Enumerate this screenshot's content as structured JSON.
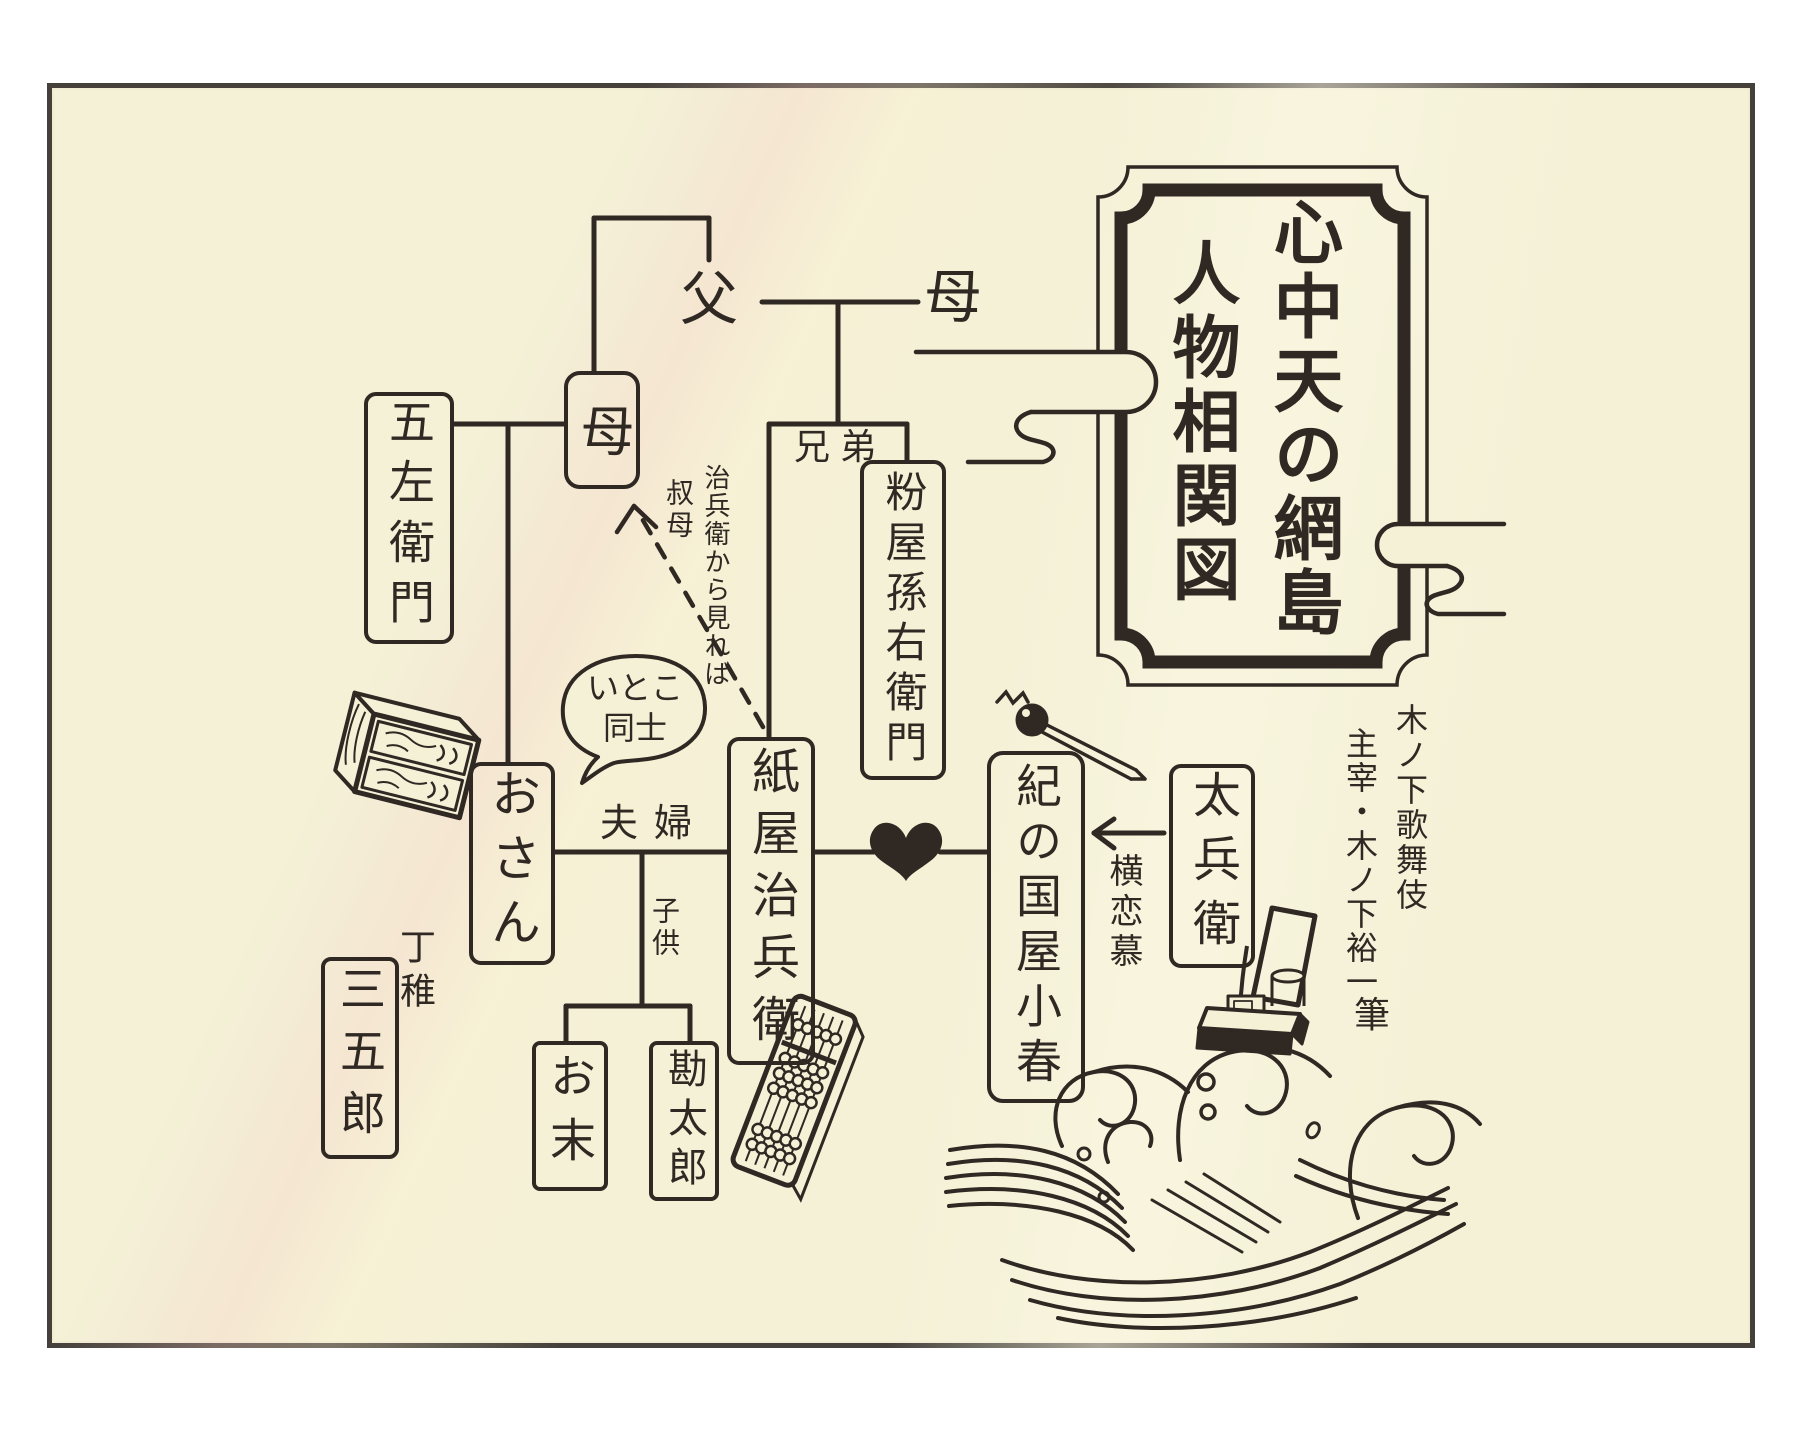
{
  "page": {
    "background": "#ffffff",
    "paper_color": "#f4f1d7",
    "ink_color": "#2f2823"
  },
  "title_box": {
    "line_main": "心中天の網島",
    "line_sub": "人物相関図"
  },
  "family_top": {
    "father": "父",
    "mother": "母",
    "siblings_label": "兄弟"
  },
  "left_family": {
    "gozaemon": "五左衛門",
    "osan_mother": "母",
    "aunt_note_main": "治兵衛から見れば",
    "aunt_note_sub": "叔母"
  },
  "couple": {
    "osan": "おさん",
    "jihei": "紙屋治兵衛",
    "couple_label": "夫婦",
    "cousins_bubble_line1": "いとこ",
    "cousins_bubble_line2": "同士"
  },
  "children": {
    "label": "子供",
    "osue": "お末",
    "kantaro": "勘太郎"
  },
  "apprentice": {
    "label": "丁稚",
    "sangoro": "三五郎"
  },
  "brother": {
    "magoemon": "粉屋孫右衛門"
  },
  "lovers": {
    "koharu": "紀の国屋小春",
    "tahei": "太兵衛",
    "rival_label": "横恋慕"
  },
  "signature": {
    "company": "木ノ下歌舞伎",
    "author": "主宰・木ノ下裕一",
    "brush": "筆"
  },
  "icons": {
    "heart": "♥",
    "cloud_left": "cloud-scroll",
    "cloud_right": "cloud-scroll",
    "waves": "wave-crests",
    "kiseru": "smoking-pipe",
    "tansu": "chest-of-drawers",
    "soroban": "abacus",
    "tobacco_tray": "tabako-bon",
    "speech_bubble": "cousins-bubble",
    "dashed_arrow": "aunt-view-arrow"
  }
}
